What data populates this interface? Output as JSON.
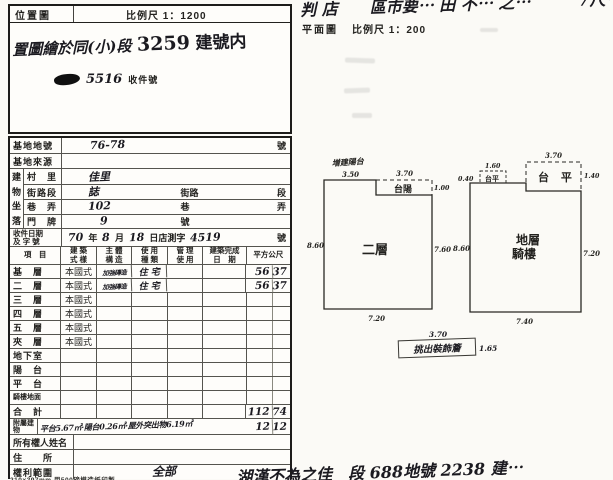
{
  "location_map": {
    "title": "位置圖",
    "scale": "比例尺 1：1200",
    "note_prefix": "置圖繪於同(小)段",
    "note_number": "3259",
    "note_suffix": "建號内",
    "stamp_number": "5516",
    "stamp_label": "收件號"
  },
  "plan_header": {
    "cutoff_note": "判 店　　區市要⋯ 田 不⋯ 之⋯　　　7尺⋯",
    "title": "平面圖",
    "scale": "比例尺 1：200"
  },
  "site_rows": [
    {
      "label": "基地地號",
      "value": "76-78",
      "suffix": "號"
    },
    {
      "label": "基地來源",
      "value": "",
      "suffix": ""
    }
  ],
  "address": {
    "group_chars": [
      "建",
      "物",
      "坐",
      "落"
    ],
    "rows": [
      {
        "label": "村　里",
        "value": "佳里",
        "mid": "",
        "suffix": ""
      },
      {
        "label": "街路段",
        "value": "誌",
        "mid": "街路",
        "suffix": "段"
      },
      {
        "label": "巷　弄",
        "value": "102",
        "mid": "巷",
        "suffix": "弄"
      },
      {
        "label": "門　牌",
        "value": "9",
        "mid": "號",
        "suffix": ""
      }
    ]
  },
  "receipt": {
    "label_line1": "收件日期",
    "label_line2": "及 字 號",
    "year": "70",
    "year_unit": "年",
    "month": "8",
    "month_unit": "月",
    "day": "18",
    "day_unit": "日店測字",
    "number": "4519",
    "suffix": "號"
  },
  "floors": {
    "headers": [
      {
        "l1": "項　目",
        "l2": ""
      },
      {
        "l1": "建 築",
        "l2": "式 樣"
      },
      {
        "l1": "主 體",
        "l2": "構 造"
      },
      {
        "l1": "使 用",
        "l2": "種 類"
      },
      {
        "l1": "管 理",
        "l2": "使 用"
      },
      {
        "l1": "建築完成",
        "l2": "日　期"
      },
      {
        "l1": "平方公尺",
        "l2": ""
      }
    ],
    "rows": [
      {
        "label": "基　層",
        "style": "本國式",
        "structure": "加強磚造",
        "use": "住 宅",
        "a1": "56",
        "a2": "37"
      },
      {
        "label": "二　層",
        "style": "本國式",
        "structure": "加強磚造",
        "use": "住 宅",
        "a1": "56",
        "a2": "37"
      },
      {
        "label": "三　層",
        "style": "本國式",
        "structure": "",
        "use": "",
        "a1": "",
        "a2": ""
      },
      {
        "label": "四　層",
        "style": "本國式",
        "structure": "",
        "use": "",
        "a1": "",
        "a2": ""
      },
      {
        "label": "五　層",
        "style": "本國式",
        "structure": "",
        "use": "",
        "a1": "",
        "a2": ""
      },
      {
        "label": "夾　層",
        "style": "本國式",
        "structure": "",
        "use": "",
        "a1": "",
        "a2": ""
      },
      {
        "label": "地下室",
        "style": "",
        "structure": "",
        "use": "",
        "a1": "",
        "a2": ""
      },
      {
        "label": "陽　台",
        "style": "",
        "structure": "",
        "use": "",
        "a1": "",
        "a2": ""
      },
      {
        "label": "平　台",
        "style": "",
        "structure": "",
        "use": "",
        "a1": "",
        "a2": ""
      },
      {
        "label": "騎樓地面",
        "style": "",
        "structure": "",
        "use": "",
        "a1": "",
        "a2": ""
      }
    ],
    "total_label": "合　計",
    "total_a1": "112",
    "total_a2": "74",
    "annex_label": "附屬建物",
    "annex_note": "平台5.67㎡·陽台0.26㎡·屋外突出物6.19㎡",
    "annex_a1": "12",
    "annex_a2": "12"
  },
  "owner": {
    "name_label": "所有權人姓名",
    "address_label": "住　　所",
    "rights_label": "權利範圍",
    "rights_value": "全部"
  },
  "paper_note": "210×297mm 用500磅模造紙印製",
  "plans": {
    "second_floor": {
      "name": "二層",
      "balcony": "台陽",
      "annotation": "増建陽台",
      "dim_top_left": "3.50",
      "dim_top": "3.70",
      "dim_notch": "1.00",
      "dim_left": "8.60",
      "dim_right": "7.60",
      "dim_bottom": "7.20"
    },
    "ground_floor": {
      "name_line1": "地層",
      "name_line2": "騎樓",
      "platform": "台 平",
      "small_platform": "台平",
      "dim_small_top": "1.60",
      "dim_small_left": "0.40",
      "dim_top": "3.70",
      "dim_notch": "1.40",
      "dim_left": "8.60",
      "dim_right": "7.20",
      "dim_bottom": "7.40"
    },
    "eave": {
      "dim_top": "3.70",
      "label": "挑出裝飾簷",
      "dim_right": "1.65"
    }
  },
  "bottom_note": "湖漢不為之佳　段 688地號 2238 建⋯"
}
